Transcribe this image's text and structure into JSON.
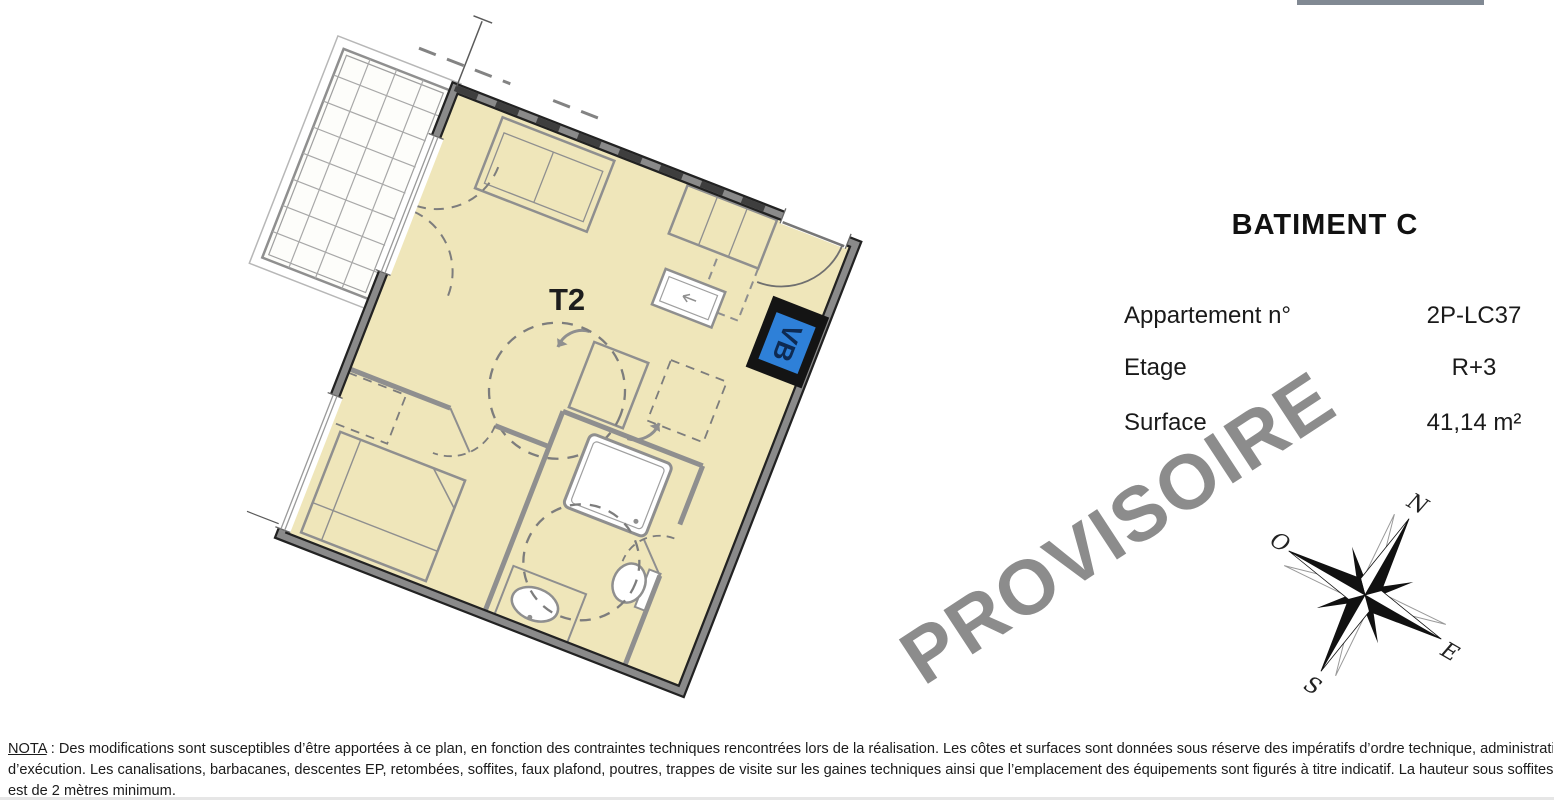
{
  "plan": {
    "t2_label": "T2",
    "vb_label": "VB",
    "floor_color": "#efe6ba",
    "wall_gray": "#8a8a8a",
    "wall_dark": "#222222",
    "accent_blue": "#2e80d8",
    "vb_text_color": "#0e2a52"
  },
  "info_panel": {
    "title": "BATIMENT C",
    "rows": [
      {
        "label": "Appartement n°",
        "value": "2P-LC37"
      },
      {
        "label": "Etage",
        "value": "R+3"
      },
      {
        "label": "Surface",
        "value": "41,14 m²"
      }
    ]
  },
  "watermark": {
    "text": "PROVISOIRE",
    "color": "#8c8c8c"
  },
  "compass": {
    "north": "N",
    "south": "S",
    "east": "E",
    "west": "O"
  },
  "nota": {
    "label": "NOTA",
    "line1_rest": " : Des modifications sont susceptibles d’être apportées à ce plan, en fonction des contraintes techniques rencontrées lors de la réalisation. Les côtes et surfaces sont données sous réserve des impératifs d’ordre technique, administratifs ou de tolérance",
    "line2": "d’exécution. Les canalisations, barbacanes, descentes EP, retombées, soffites, faux plafond, poutres, trappes de visite sur les gaines techniques ainsi que l’emplacement des équipements sont figurés à titre indicatif. La hauteur sous soffites, faux plafond ou poutres",
    "line3": "est de 2 mètres minimum."
  }
}
